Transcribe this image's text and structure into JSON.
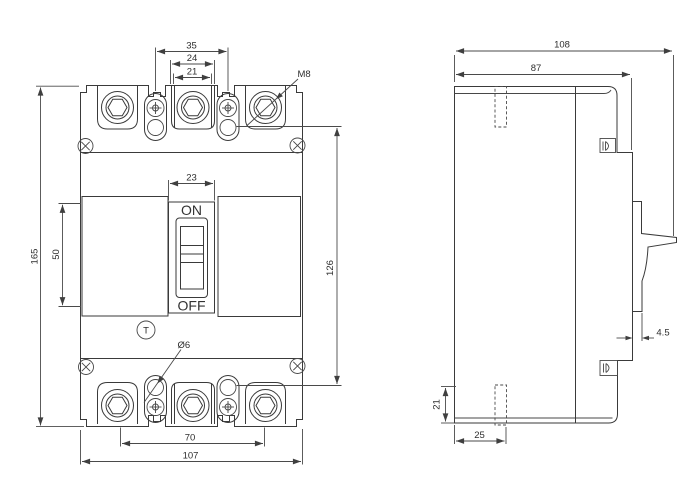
{
  "front_view": {
    "dimensions": {
      "terminal_slot_spacing": "35",
      "pole_outer_width": "24",
      "pole_inner_width": "21",
      "recess_width": "23",
      "overall_height": "165",
      "cover_height": "50",
      "mounting_hole_spacing": "126",
      "terminal_pitch": "70",
      "overall_width": "107"
    },
    "callouts": {
      "terminal_thread": "M8",
      "mounting_hole_diameter": "Ø6"
    },
    "switch": {
      "on_label": "ON",
      "off_label": "OFF"
    },
    "trip_button_label": "T"
  },
  "side_view": {
    "dimensions": {
      "overall_depth": "108",
      "body_depth": "87",
      "handle_thickness": "4.5",
      "base_height": "21",
      "slot_offset": "25"
    }
  }
}
